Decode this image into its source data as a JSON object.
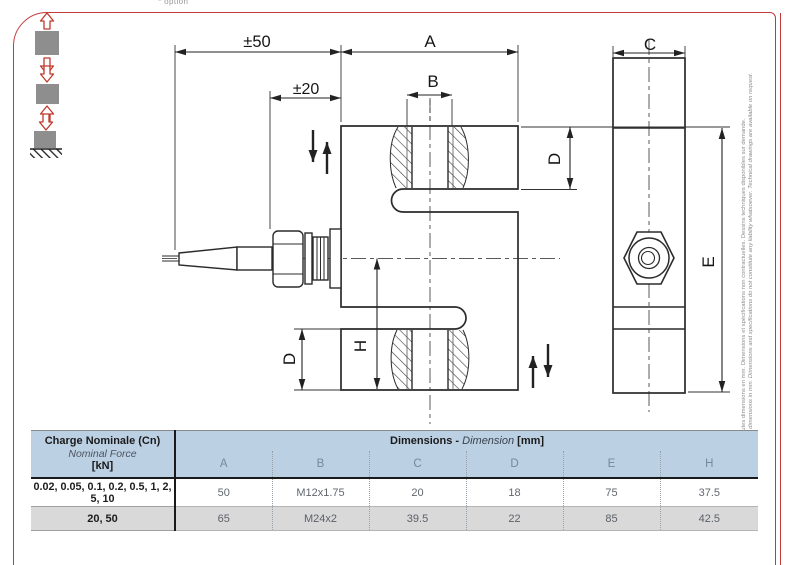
{
  "page": {
    "option_note": "* option",
    "side_note_fr": "Toutes dimensions en mm. Dimensions et spécifications non contractuelles. Dessins techniques disponibles sur demande.",
    "side_note_en": "All dimensions in mm. Dimensions and specifications do not constitute any liability whatsoever. Technical drawings are available on request."
  },
  "drawing": {
    "dims": {
      "pm50": "±50",
      "pm20": "±20",
      "A": "A",
      "B": "B",
      "C": "C",
      "D": "D",
      "E": "E",
      "H": "H"
    },
    "icons": [
      "tension-both-directions-icon",
      "compression-both-directions-icon",
      "compression-on-base-icon"
    ]
  },
  "table": {
    "col1_header": {
      "line1": "Charge Nominale (Cn)",
      "line2": "Nominal Force",
      "line3": "[kN]"
    },
    "dims_header": {
      "part1": "Dimensions - ",
      "part2": "Dimension",
      "part3": " [mm]"
    },
    "columns": [
      "A",
      "B",
      "C",
      "D",
      "E",
      "H"
    ],
    "rows": [
      {
        "force": "0.02, 0.05, 0.1, 0.2, 0.5, 1, 2, 5, 10",
        "values": [
          "50",
          "M12x1.75",
          "20",
          "18",
          "75",
          "37.5"
        ]
      },
      {
        "force": "20, 50",
        "values": [
          "65",
          "M24x2",
          "39.5",
          "22",
          "85",
          "42.5"
        ]
      }
    ]
  },
  "colors": {
    "frame_red": "#c13b3b",
    "header_blue": "#bcd0e4",
    "row_alt_gray": "#d9d9d9",
    "drawing_line": "#2e2e2e"
  }
}
